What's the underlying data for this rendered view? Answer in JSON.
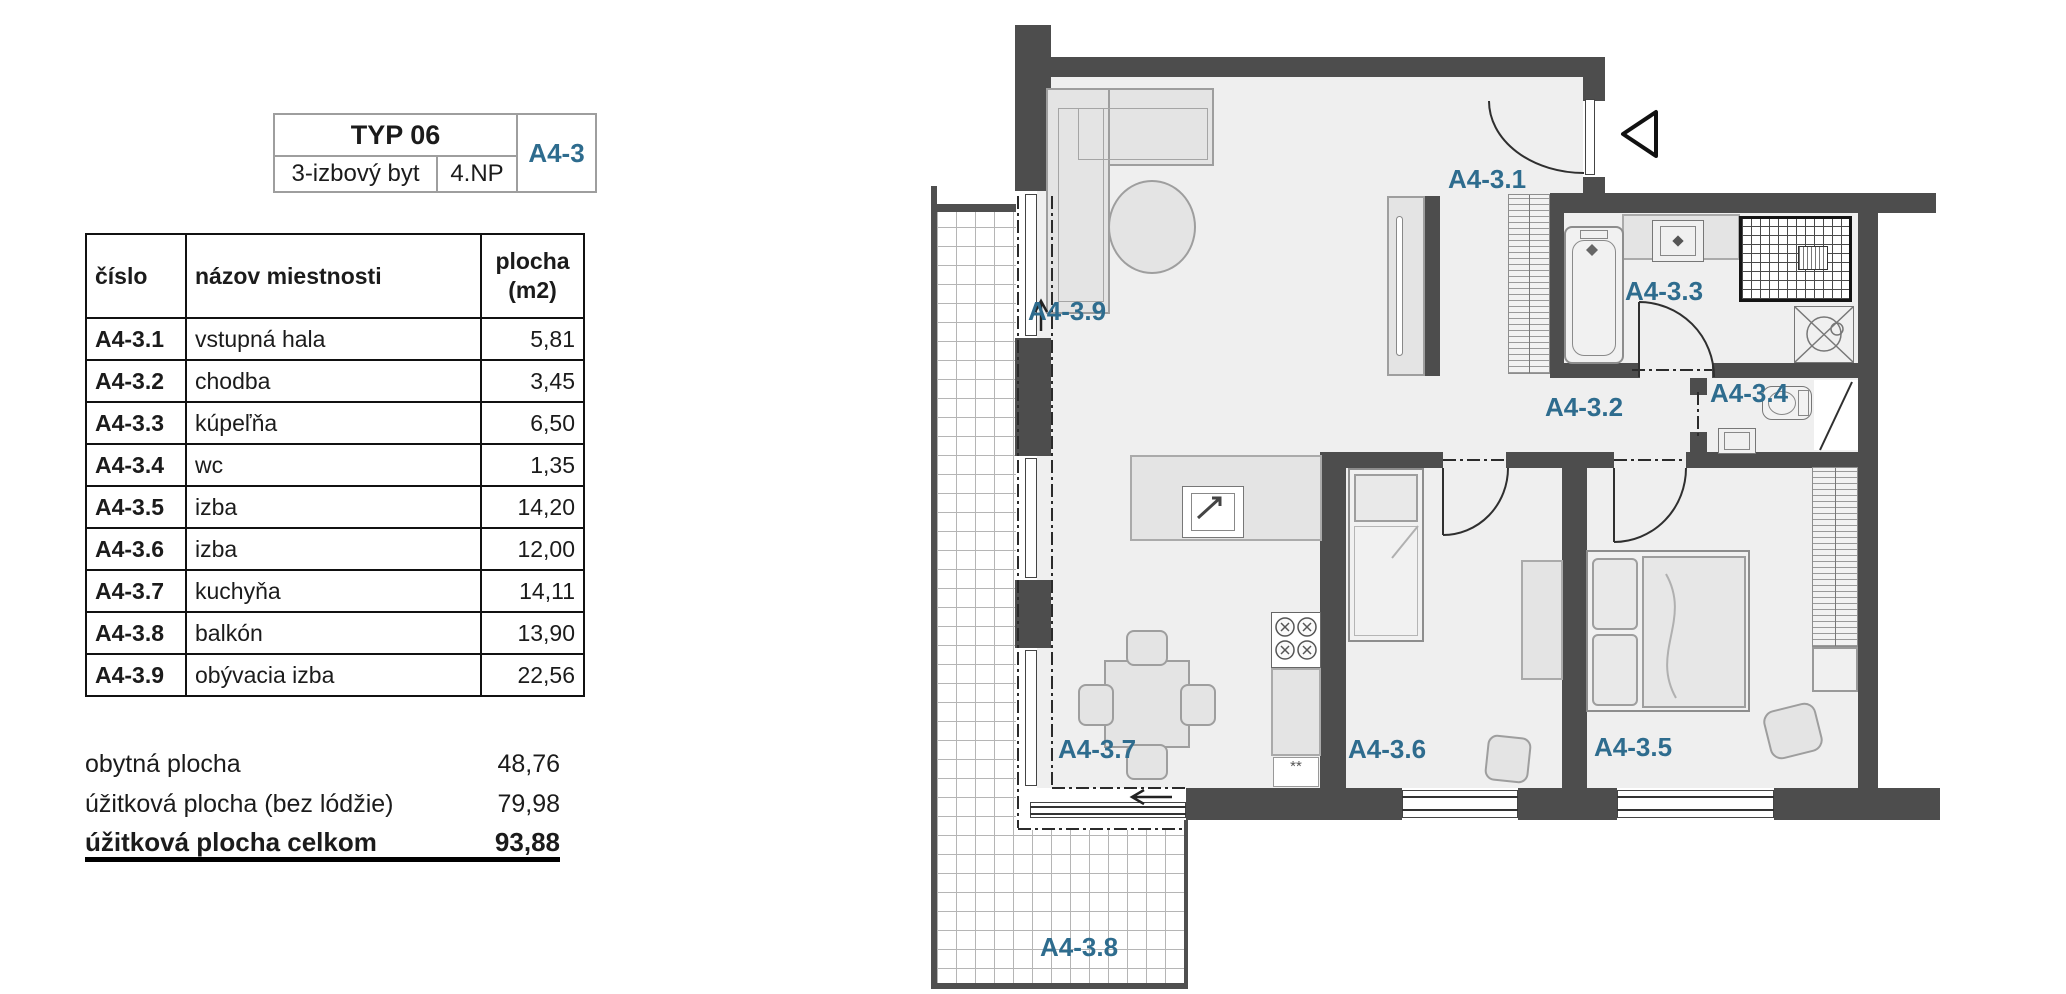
{
  "panel": {
    "title_block": {
      "type": "TYP 06",
      "layout": "3-izbový byt",
      "floor": "4.NP",
      "unit": "A4-3"
    },
    "table": {
      "headers": {
        "col1": "číslo",
        "col2": "názov miestnosti",
        "col3_line1": "plocha",
        "col3_line2": "(m2)"
      },
      "rows": [
        {
          "id": "A4-3.1",
          "name": "vstupná hala",
          "area": "5,81"
        },
        {
          "id": "A4-3.2",
          "name": "chodba",
          "area": "3,45"
        },
        {
          "id": "A4-3.3",
          "name": "kúpeľňa",
          "area": "6,50"
        },
        {
          "id": "A4-3.4",
          "name": "wc",
          "area": "1,35"
        },
        {
          "id": "A4-3.5",
          "name": "izba",
          "area": "14,20"
        },
        {
          "id": "A4-3.6",
          "name": "izba",
          "area": "12,00"
        },
        {
          "id": "A4-3.7",
          "name": "kuchyňa",
          "area": "14,11"
        },
        {
          "id": "A4-3.8",
          "name": "balkón",
          "area": "13,90"
        },
        {
          "id": "A4-3.9",
          "name": "obývacia izba",
          "area": "22,56"
        }
      ]
    },
    "summary": [
      {
        "label": "obytná plocha",
        "value": "48,76"
      },
      {
        "label": "úžitková plocha (bez lódžie)",
        "value": "79,98"
      },
      {
        "label": "úžitková plocha celkom",
        "value": "93,88"
      }
    ]
  },
  "plan": {
    "labels": [
      {
        "text": "A4-3.9"
      },
      {
        "text": "A4-3.1"
      },
      {
        "text": "A4-3.3"
      },
      {
        "text": "A4-3.2"
      },
      {
        "text": "A4-3.4"
      },
      {
        "text": "A4-3.7"
      },
      {
        "text": "A4-3.6"
      },
      {
        "text": "A4-3.5"
      },
      {
        "text": "A4-3.8"
      }
    ],
    "kitchen_marker": "**"
  },
  "colors": {
    "accent": "#2e6c8e",
    "wall": "#4d4d4d"
  }
}
